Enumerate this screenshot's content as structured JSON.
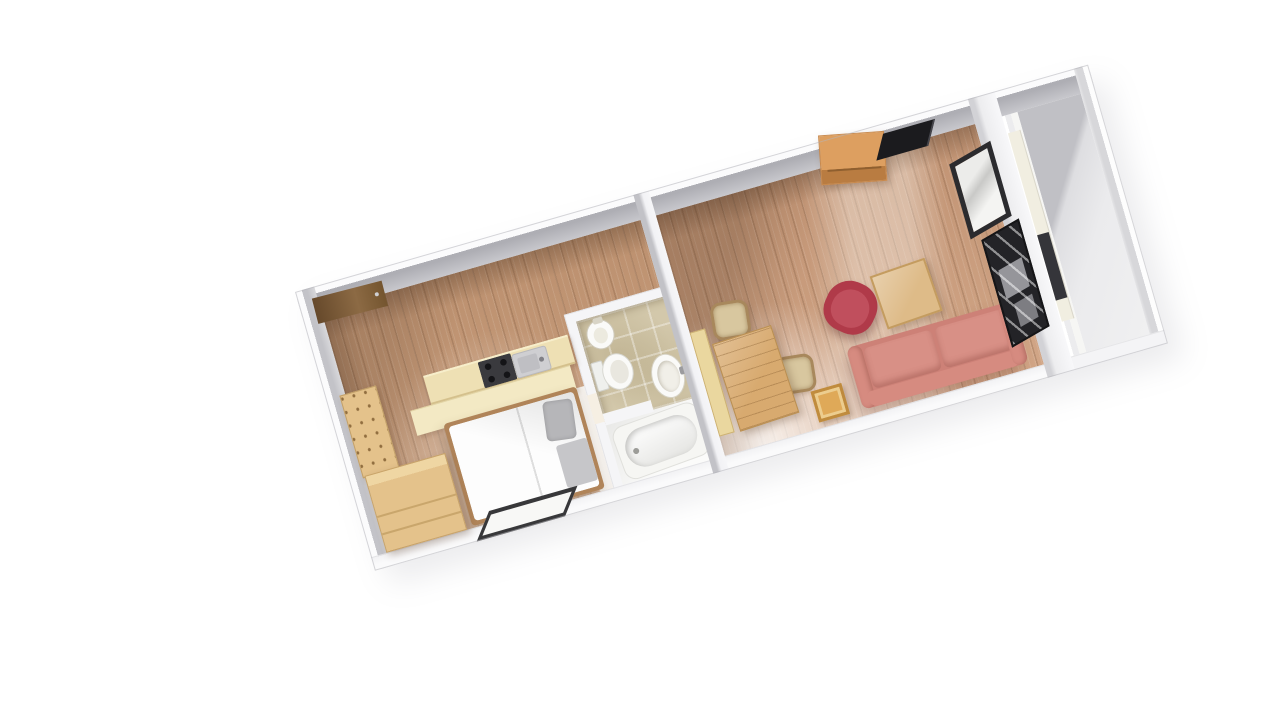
{
  "scene": {
    "type": "3d-floorplan-render",
    "view": "aerial oblique top-down",
    "background": "#ffffff",
    "plan_rotation_deg": -16
  },
  "palette": {
    "wall_white": "#f5f5f7",
    "wall_face": "#b9b9be",
    "wood_floor": "#c59876",
    "wood_floor_living": "#cb9c7c",
    "tile_beige": "#d3c8ab",
    "sideroom_floor": "#e9e9eb",
    "door_brown": "#8c6a44",
    "wood_light": "#e4c28b",
    "counter_cream": "#eee0b4",
    "table_wood": "#d8aa6f",
    "stool_wood": "#dfa958",
    "sideboard_wood": "#dd9f60",
    "chair_wicker": "#d8c79f",
    "sofa_salmon": "#cd8177",
    "sofa_cushion": "#d89086",
    "armchair_red": "#b03a49",
    "fixture_white": "#fafaf8",
    "appliance_dark": "#3a3a3e",
    "shelf_dark": "#232327",
    "bed_white": "#fdfdfd",
    "pillow_gray": "#b6b6b9"
  },
  "rooms": [
    {
      "id": "bedroom-kitchen",
      "label": "Bedroom with kitchenette",
      "floor_material": "light wood planks",
      "furniture": [
        "entrance door",
        "tall cabinet",
        "wardrobe",
        "kitchen counter",
        "cooktop",
        "kitchen sink",
        "double bed with gray pillow",
        "leaning picture frame"
      ]
    },
    {
      "id": "bathroom",
      "label": "Bathroom",
      "floor_material": "beige tiles",
      "furniture": [
        "bidet",
        "toilet",
        "washbasin",
        "bathtub"
      ]
    },
    {
      "id": "living-room",
      "label": "Living room",
      "floor_material": "light wood planks",
      "furniture": [
        "sideboard",
        "flat tv",
        "dining bench",
        "dining table",
        "dining chair top",
        "dining chair right",
        "red swivel armchair",
        "coffee table",
        "side stool",
        "two-seat salmon sofa",
        "wall picture frame",
        "dark media shelf"
      ]
    },
    {
      "id": "side-room",
      "label": "Empty side room",
      "floor_material": "bare gray floor",
      "furniture": [
        "radiator"
      ]
    }
  ]
}
